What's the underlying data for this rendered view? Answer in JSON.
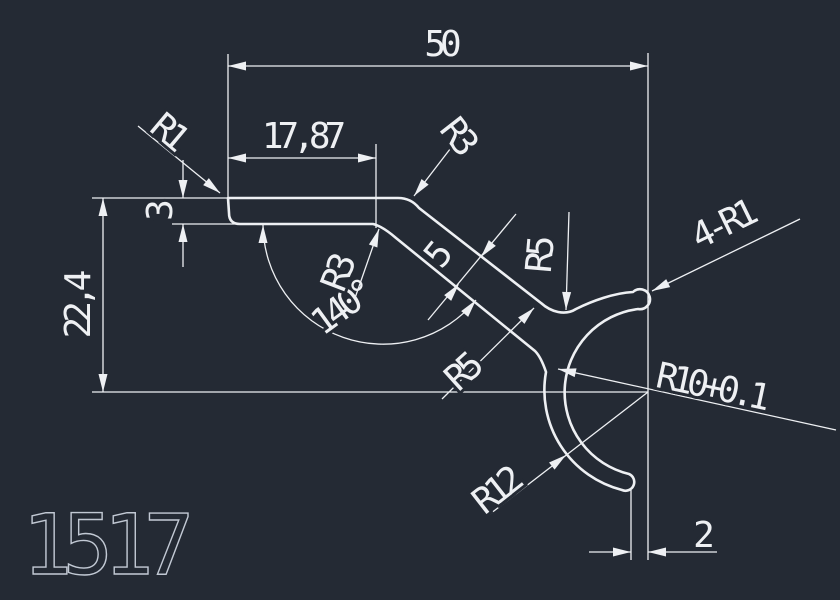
{
  "drawing": {
    "part_number": "1517",
    "colors": {
      "background": "#242a34",
      "line": "#eef0f3",
      "part_label": "#c2c9d4"
    },
    "dimensions": {
      "overall_width": "50",
      "top_offset": "17,87",
      "overall_height": "22,4",
      "wall_thickness": "3",
      "bend_angle": "140°",
      "strip_width": "5",
      "tip_gap": "2"
    },
    "radius_labels": {
      "r1": "R1",
      "r3_outer": "R3",
      "r3_inner": "R3",
      "r5_upper": "R5",
      "r5_lower": "R5",
      "four_r1": "4-R1",
      "r10": "R10+0.1",
      "r12": "R12"
    }
  }
}
